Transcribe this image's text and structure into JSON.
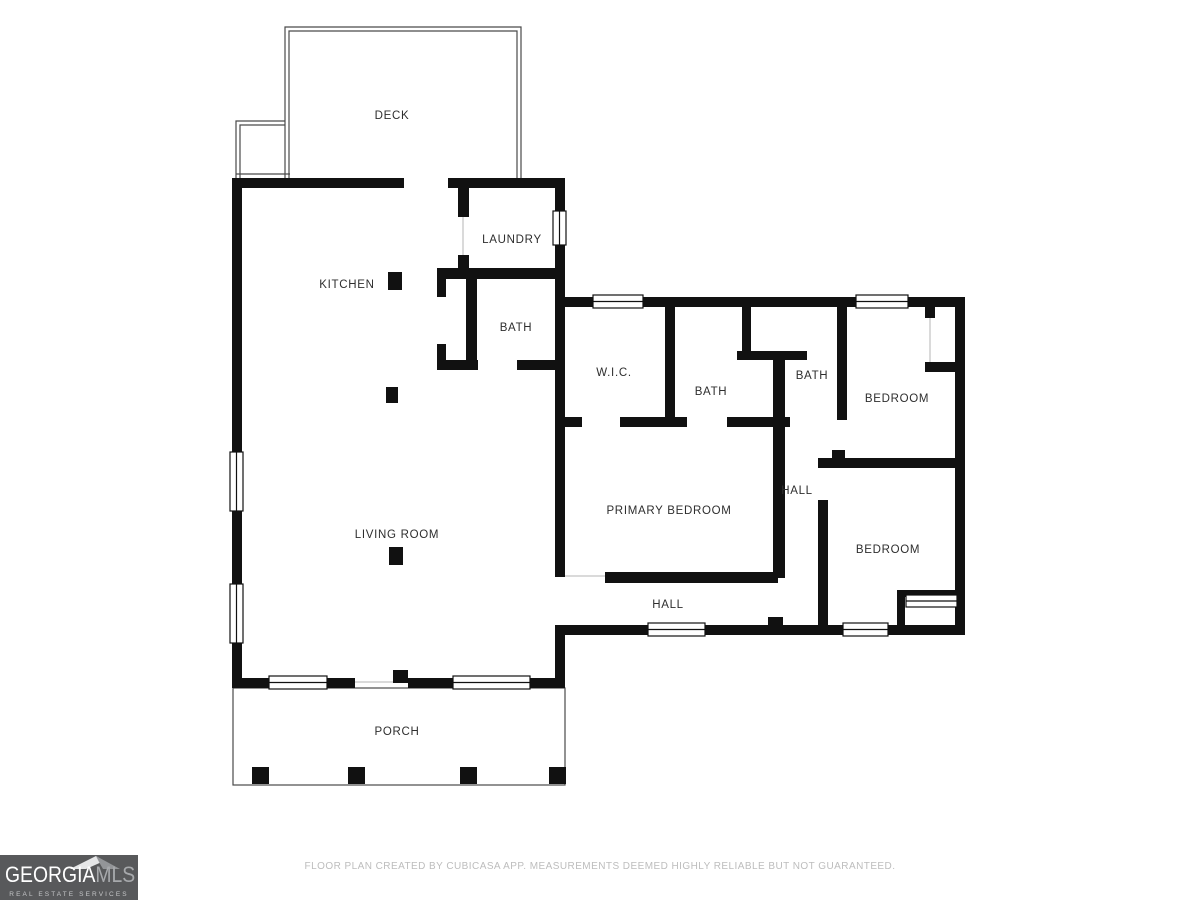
{
  "floor_plan": {
    "rooms": {
      "deck": "DECK",
      "laundry": "LAUNDRY",
      "kitchen": "KITCHEN",
      "bath_main": "BATH",
      "wic": "W.I.C.",
      "bath_middle": "BATH",
      "bath_right": "BATH",
      "bedroom_top": "BEDROOM",
      "primary_bedroom": "PRIMARY BEDROOM",
      "hall_vertical": "HALL",
      "bedroom_bottom": "BEDROOM",
      "hall_bottom": "HALL",
      "living_room": "LIVING ROOM",
      "porch": "PORCH"
    },
    "colors": {
      "wall": "#111111",
      "thin_outline": "#4a4a4a",
      "label_text": "#2e2e2e"
    }
  },
  "footer": {
    "disclaimer": "FLOOR PLAN CREATED BY CUBICASA APP. MEASUREMENTS DEEMED HIGHLY RELIABLE BUT NOT GUARANTEED.",
    "logo": {
      "name_primary": "GEORGIA",
      "name_secondary": "MLS",
      "tagline": "REAL ESTATE SERVICES",
      "background": "#58595b",
      "primary_color": "#ffffff",
      "secondary_color": "#a7a9ac"
    }
  }
}
